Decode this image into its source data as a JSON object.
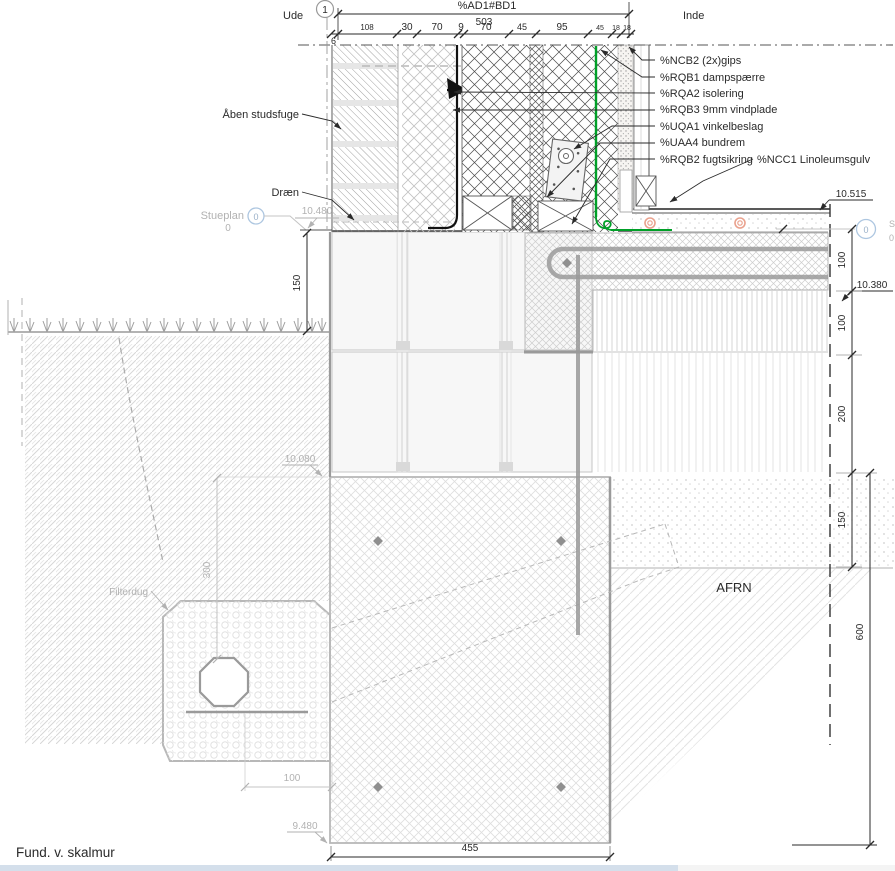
{
  "drawing": {
    "title": "Fund. v. skalmur",
    "scale": "1:5",
    "side_left": "Ude",
    "side_right": "Inde",
    "grid_bubble": "1",
    "afrn_label": "AFRN"
  },
  "top_dim": {
    "label": "%AD1#BD1",
    "total": "503",
    "chain": [
      "6",
      "108",
      "30",
      "70",
      "9",
      "70",
      "45",
      "95",
      "45",
      "18",
      "18"
    ]
  },
  "callouts": {
    "gips": "%NCB2 (2x)gips",
    "dampspaerre": "%RQB1 dampspærre",
    "isolering": "%RQA2 isolering",
    "vindplade": "%RQB3 9mm vindplade",
    "vinkelbeslag": "%UQA1 vinkelbeslag",
    "bundrem": "%UAA4 bundrem",
    "fugtsikring": "%RQB2 fugtsikring",
    "linoleumsgulv": "%NCC1 Linoleumsgulv",
    "aaben_studsfuge": "Åben studsfuge",
    "draen": "Dræn",
    "filterdug": "Filterdug"
  },
  "levels": {
    "gulv": "10.515",
    "sokkel": "10.480",
    "slab": "10.380",
    "fund_top": "10.080",
    "fund_bund": "9.480",
    "stueplan_label": "Stueplan",
    "stueplan_value": "0",
    "stueplan_bubble": "0",
    "stueplan_right_s": "S",
    "stueplan_right_0": "0"
  },
  "dims": {
    "terrain_150": "150",
    "fund_300": "300",
    "drain_100": "100",
    "fund_width_455": "455",
    "right_chain": [
      "100",
      "100",
      "200",
      "150"
    ],
    "right_600": "600"
  },
  "colors": {
    "membrane_green": "#00a028",
    "pipe_orange": "#eaa28e",
    "grid_bubble_blue": "#adc6e0",
    "annotation_gray": "#b2b2b2"
  }
}
